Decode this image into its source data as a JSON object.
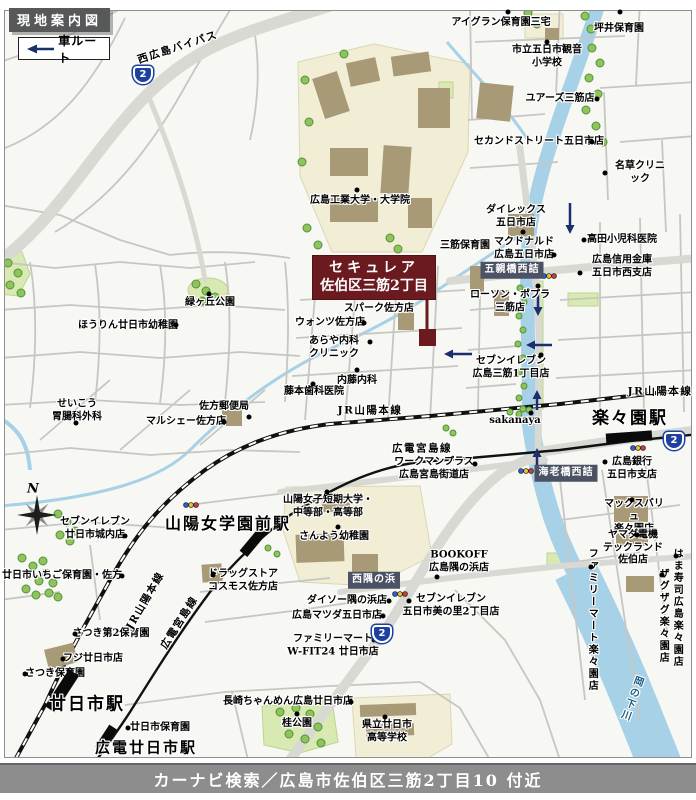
{
  "header": {
    "title": "現地案内図"
  },
  "legend": {
    "label": "車ルート"
  },
  "footer": {
    "caption": "カーナビ検索／広島市佐伯区三筋2丁目10 付近"
  },
  "site": {
    "name_line1": "セキュレア",
    "name_line2": "佐伯区三筋2丁目"
  },
  "compass": {
    "north_label": "N"
  },
  "colors": {
    "site_red": "#6b1b1f",
    "badge_bg": "#4a5264",
    "shield_blue": "#1e41a0",
    "river_blue": "#a7d1e7",
    "route_arrow_navy": "#1b2f6d"
  },
  "map": {
    "road_labels": [
      {
        "label": "西広島バイパス",
        "x": 178,
        "y": 48,
        "rotate": -18
      }
    ],
    "rail_labels": [
      {
        "label": "JR山陽本線",
        "x": 370,
        "y": 411
      },
      {
        "label": "JR山陽本線",
        "x": 660,
        "y": 392
      },
      {
        "label": "JR山陽本線",
        "x": 146,
        "y": 601,
        "rotate": -60
      },
      {
        "label": "広電宮島線",
        "x": 422,
        "y": 449
      },
      {
        "label": "広電宮島線",
        "x": 180,
        "y": 623,
        "rotate": -58
      }
    ],
    "water_labels": [
      {
        "label": "岡の下川",
        "x": 630,
        "y": 698,
        "vertical": true,
        "rotate": 20
      }
    ],
    "shields": [
      {
        "label": "2",
        "x": 143,
        "y": 75
      },
      {
        "label": "2",
        "x": 674,
        "y": 441
      },
      {
        "label": "2",
        "x": 382,
        "y": 634
      }
    ],
    "intersections": [
      {
        "label": "五親橋西詰",
        "x": 512,
        "y": 270
      },
      {
        "label": "海老橋西詰",
        "x": 566,
        "y": 473
      },
      {
        "label": "西隅の浜",
        "x": 374,
        "y": 580
      }
    ],
    "stations": [
      {
        "label": "山陽女学園前駅",
        "x": 228,
        "y": 524,
        "size": 16,
        "marker": {
          "x": 255,
          "y": 540,
          "w": 36,
          "h": 10,
          "rotate": -50
        }
      },
      {
        "label": "楽々園駅",
        "x": 630,
        "y": 419,
        "size": 17,
        "marker": {
          "x": 629,
          "y": 437,
          "w": 46,
          "h": 10,
          "rotate": -4
        }
      },
      {
        "label": "廿日市駅",
        "x": 87,
        "y": 705,
        "size": 17,
        "marker": {
          "x": 62,
          "y": 691,
          "w": 44,
          "h": 12,
          "rotate": -57
        }
      },
      {
        "label": "広電廿日市駅",
        "x": 146,
        "y": 748,
        "size": 15,
        "marker": {
          "x": 106,
          "y": 738,
          "w": 26,
          "h": 9,
          "rotate": -57
        }
      }
    ],
    "pois": [
      {
        "label": "アイグラン保育園三宅",
        "x": 501,
        "y": 23,
        "dot": [
          508,
          12
        ]
      },
      {
        "label": "坪井保育園",
        "x": 619,
        "y": 29,
        "dot": [
          620,
          12
        ]
      },
      {
        "label": "市立五日市観音\n小学校",
        "x": 547,
        "y": 57,
        "dot": [
          547,
          42
        ]
      },
      {
        "label": "ユアーズ三筋店",
        "x": 560,
        "y": 99,
        "dot": [
          597,
          99
        ]
      },
      {
        "label": "セカンドストリート五日市店",
        "x": 539,
        "y": 142,
        "dot": [
          592,
          142
        ]
      },
      {
        "label": "名草クリニック",
        "x": 640,
        "y": 173,
        "dot": [
          605,
          173
        ]
      },
      {
        "label": "ダイレックス\n五日市店",
        "x": 516,
        "y": 217,
        "dot": [
          523,
          232
        ]
      },
      {
        "label": "マクドナルド\n広島五日市店",
        "x": 524,
        "y": 249,
        "dot": [
          554,
          255
        ]
      },
      {
        "label": "高田小児科医院",
        "x": 622,
        "y": 240,
        "dot": [
          584,
          240
        ]
      },
      {
        "label": "広島信用金庫\n五日市西支店",
        "x": 622,
        "y": 267,
        "dot": [
          580,
          273
        ]
      },
      {
        "label": "三筋保育園",
        "x": 465,
        "y": 246
      },
      {
        "label": "ローソン・ポプラ\n三筋店",
        "x": 510,
        "y": 302,
        "dot": [
          538,
          286
        ]
      },
      {
        "label": "広島工業大学・大学院",
        "x": 360,
        "y": 201,
        "dot": [
          357,
          190
        ]
      },
      {
        "label": "緑ヶ丘公園",
        "x": 210,
        "y": 303,
        "dot": [
          209,
          294
        ]
      },
      {
        "label": "ほうりん廿日市幼稚園",
        "x": 128,
        "y": 326,
        "dot": [
          176,
          325
        ]
      },
      {
        "label": "スパーク佐方店",
        "x": 379,
        "y": 309
      },
      {
        "label": "ウォンツ佐方店",
        "x": 330,
        "y": 323,
        "dot": [
          364,
          323
        ]
      },
      {
        "label": "あらや内科\nクリニック",
        "x": 334,
        "y": 348,
        "dot": [
          370,
          342
        ]
      },
      {
        "label": "内藤内科",
        "x": 357,
        "y": 381,
        "dot": [
          357,
          370
        ]
      },
      {
        "label": "藤本歯科医院",
        "x": 314,
        "y": 392,
        "dot": [
          313,
          384
        ]
      },
      {
        "label": "せいこう\n胃腸科外科",
        "x": 77,
        "y": 411,
        "dot": [
          76,
          423
        ]
      },
      {
        "label": "佐方郵便局",
        "x": 224,
        "y": 407,
        "dot": [
          249,
          417
        ]
      },
      {
        "label": "マルシェー佐方店",
        "x": 186,
        "y": 422,
        "dot": [
          224,
          422
        ]
      },
      {
        "label": "セブンイレブン\n広島三筋1丁目店",
        "x": 511,
        "y": 368,
        "dot": [
          541,
          355
        ]
      },
      {
        "label": "sakanaya",
        "x": 515,
        "y": 421,
        "dot": [
          531,
          413
        ]
      },
      {
        "label": "ワークマンプラス\n広島宮島街道店",
        "x": 434,
        "y": 469,
        "dot": [
          475,
          464
        ]
      },
      {
        "label": "広島銀行\n五日市支店",
        "x": 632,
        "y": 469,
        "dot": [
          605,
          462
        ]
      },
      {
        "label": "マックスバリュ\n楽々園店",
        "x": 634,
        "y": 517,
        "dot": [
          632,
          500
        ]
      },
      {
        "label": "ヤマダ電機\nテックランド佐伯店",
        "x": 633,
        "y": 548,
        "dot": [
          637,
          535
        ]
      },
      {
        "label": "BOOKOFF\n広島隅の浜店",
        "x": 459,
        "y": 562,
        "dot": [
          437,
          577
        ]
      },
      {
        "label": "ダイソー隅の浜店",
        "x": 347,
        "y": 601,
        "dot": [
          389,
          601
        ]
      },
      {
        "label": "広島マツダ五日市店",
        "x": 337,
        "y": 616,
        "dot": [
          383,
          616
        ]
      },
      {
        "label": "セブンイレブン\n五日市美の里2丁目店",
        "x": 451,
        "y": 606,
        "dot": [
          409,
          601
        ]
      },
      {
        "label": "ファミリーマート\nW-FIT24 廿日市店",
        "x": 333,
        "y": 646,
        "dot": [
          374,
          640
        ]
      },
      {
        "label": "セブンイレブン\n廿日市城内店",
        "x": 95,
        "y": 529,
        "dot": [
          125,
          536
        ]
      },
      {
        "label": "廿日市いちご保育園・佐方",
        "x": 62,
        "y": 576,
        "dot": [
          122,
          576
        ]
      },
      {
        "label": "山陽女子短期大学・\n中等部・高等部",
        "x": 328,
        "y": 507,
        "dot": [
          327,
          492
        ]
      },
      {
        "label": "さんよう幼稚園",
        "x": 334,
        "y": 537,
        "dot": [
          338,
          527
        ]
      },
      {
        "label": "ドラッグストア\nコスモス佐方店",
        "x": 243,
        "y": 581,
        "dot": [
          213,
          575
        ]
      },
      {
        "label": "さつき第2保育園",
        "x": 111,
        "y": 634,
        "dot": [
          75,
          634
        ]
      },
      {
        "label": "フジ廿日市店",
        "x": 93,
        "y": 659,
        "dot": [
          63,
          659
        ]
      },
      {
        "label": "さつき保育園",
        "x": 55,
        "y": 674,
        "dot": [
          25,
          674
        ]
      },
      {
        "label": "廿日市保育園",
        "x": 160,
        "y": 728,
        "dot": [
          128,
          728
        ]
      },
      {
        "label": "長崎ちゃんめん広島廿日市店",
        "x": 288,
        "y": 702,
        "dot": [
          351,
          702
        ]
      },
      {
        "label": "桂公園",
        "x": 297,
        "y": 724,
        "dot": [
          297,
          714
        ]
      },
      {
        "label": "県立廿日市\n高等学校",
        "x": 387,
        "y": 732,
        "dot": [
          385,
          717
        ]
      },
      {
        "label": "はま寿司広島楽々園店",
        "x": 676,
        "y": 608,
        "vertical": true,
        "dot": [
          676,
          556
        ]
      },
      {
        "label": "ザグザグ楽々園店",
        "x": 662,
        "y": 616,
        "vertical": true,
        "dot": [
          662,
          575
        ]
      },
      {
        "label": "ファミリーマート楽々園店",
        "x": 591,
        "y": 620,
        "vertical": true,
        "dot": [
          591,
          567
        ]
      }
    ]
  }
}
